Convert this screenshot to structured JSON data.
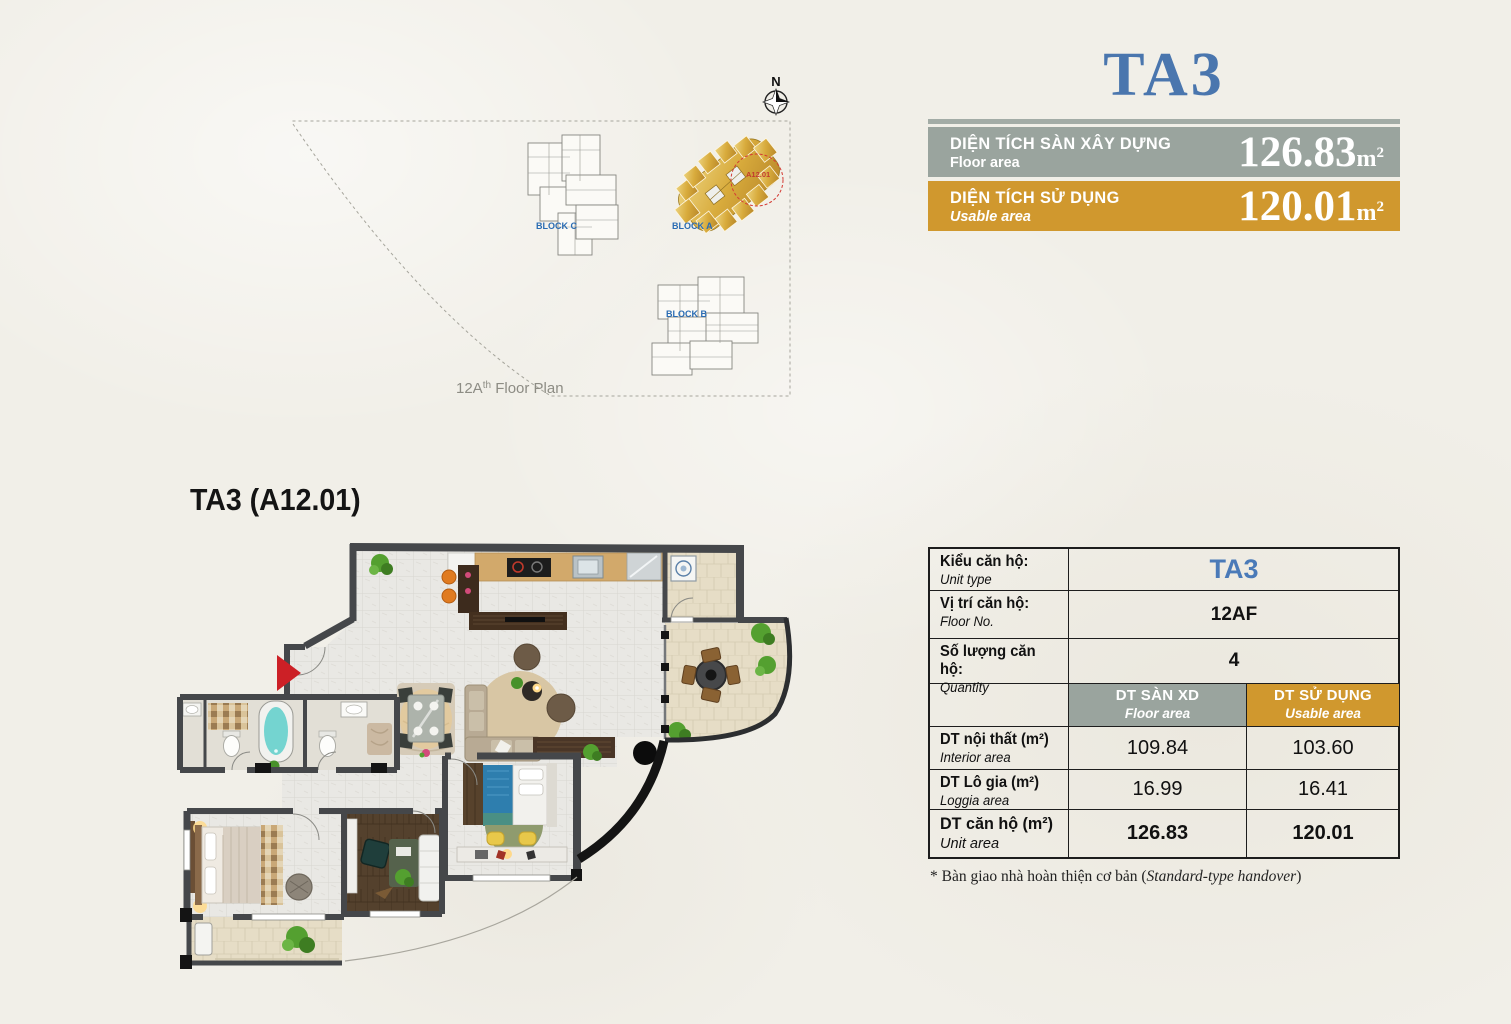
{
  "unit": {
    "title": "TA3",
    "plan_label": "TA3 (A12.01)"
  },
  "banners": {
    "floor": {
      "vn": "DIỆN TÍCH SÀN XÂY DỰNG",
      "en": "Floor area",
      "value": "126.83",
      "unit_base": "m",
      "unit_exp": "2"
    },
    "usable": {
      "vn": "DIỆN TÍCH SỬ DỤNG",
      "en": "Usable area",
      "value": "120.01",
      "unit_base": "m",
      "unit_exp": "2"
    }
  },
  "site": {
    "compass_n": "N",
    "block_a": "BLOCK A",
    "block_b": "BLOCK B",
    "block_c": "BLOCK C",
    "unit_highlight": "A12.01",
    "caption_base": "12A",
    "caption_sup": "th",
    "caption_rest": " Floor Plan"
  },
  "table": {
    "info_rows": [
      {
        "vn": "Kiểu căn hộ:",
        "en": "Unit type",
        "value": "TA3"
      },
      {
        "vn": "Vị trí căn hộ:",
        "en": "Floor No.",
        "value": "12AF"
      },
      {
        "vn": "Số lượng căn hộ:",
        "en": "Quantity",
        "value": "4"
      }
    ],
    "col_headers": [
      {
        "vn": "DT SÀN XD",
        "en": "Floor area"
      },
      {
        "vn": "DT SỬ DỤNG",
        "en": "Usable area"
      }
    ],
    "area_rows": [
      {
        "vn": "DT nội thất (m²)",
        "en": "Interior area",
        "floor": "109.84",
        "usable": "103.60"
      },
      {
        "vn": "DT Lô gia (m²)",
        "en": "Loggia area",
        "floor": "16.99",
        "usable": "16.41"
      },
      {
        "vn": "DT căn hộ (m²)",
        "en": "Unit area",
        "floor": "126.83",
        "usable": "120.01"
      }
    ]
  },
  "footnote": {
    "prefix": "* Bàn giao nhà hoàn thiện cơ bản (",
    "italic": "Standard-type handover",
    "suffix": ")"
  },
  "colors": {
    "accent_blue": "#4a76ae",
    "band_gray": "#9aa49e",
    "band_gold": "#d0982e",
    "block_label_blue": "#2a6cb3",
    "highlight_red": "#d43a33",
    "entrance_red": "#cc2026"
  }
}
